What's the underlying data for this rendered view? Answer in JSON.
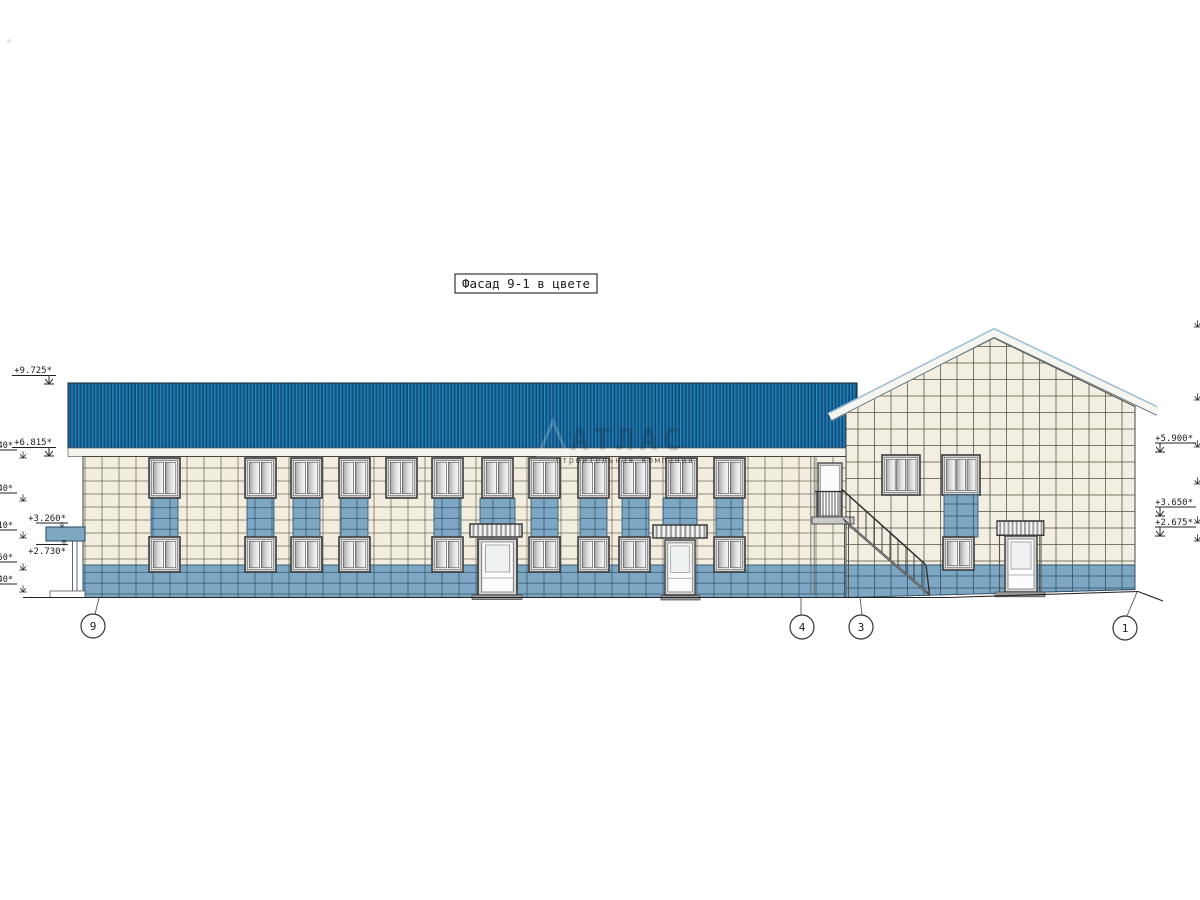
{
  "drawing": {
    "title": "Фасад 9-1 в цвете"
  },
  "watermark": {
    "name": "АТЛАС",
    "tagline": "строительная компания"
  },
  "elevations": {
    "left": [
      {
        "value": "+9.725*"
      },
      {
        "value": "+6.815*"
      },
      {
        "value": "+3.260*"
      },
      {
        "value": "+2.730*"
      }
    ],
    "left_edge": [
      {
        "value": "40*"
      },
      {
        "value": "40*"
      },
      {
        "value": "10*"
      },
      {
        "value": "50*"
      },
      {
        "value": "40*"
      }
    ],
    "right": [
      {
        "value": "+5.900*"
      },
      {
        "value": "+3.650*"
      },
      {
        "value": "+2.675*"
      }
    ]
  },
  "axes": [
    {
      "label": "9"
    },
    {
      "label": "4"
    },
    {
      "label": "3"
    },
    {
      "label": "1"
    }
  ],
  "colors": {
    "roof_blue": "#15639a",
    "wall_cream": "#f2edde",
    "panel_blue": "#7da7c2",
    "line": "#3a3a3a"
  }
}
